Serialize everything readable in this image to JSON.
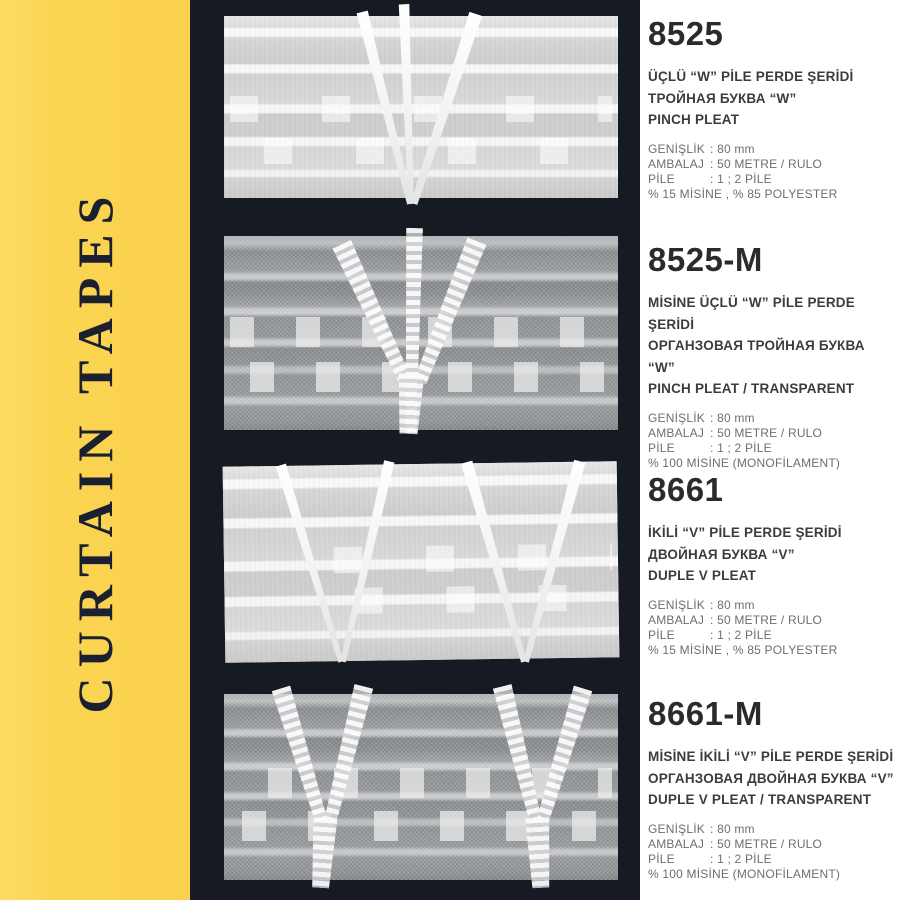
{
  "sidebar": {
    "title": "CURTAIN TAPES"
  },
  "colors": {
    "accent_yellow": "#fbd452",
    "panel_dark": "#161a23",
    "title_text": "#2b2b2b",
    "spec_text": "#6e6e6e",
    "sidebar_text": "#1b2030"
  },
  "products": [
    {
      "code": "8525",
      "image": "pinch-pleat-opaque-tape",
      "names": [
        "ÜÇLÜ “W” PİLE PERDE ŞERİDİ",
        "ТРОЙНАЯ БУКВА “W”",
        "PINCH PLEAT"
      ],
      "specs": [
        {
          "label": "GENİŞLİK",
          "value": ": 80 mm"
        },
        {
          "label": "AMBALAJ",
          "value": ": 50 METRE / RULO"
        },
        {
          "label": "PİLE",
          "value": ": 1 ; 2 PİLE"
        }
      ],
      "composition": "% 15 MİSİNE , % 85 POLYESTER"
    },
    {
      "code": "8525-M",
      "image": "pinch-pleat-transparent-tape",
      "names": [
        "MİSİNE ÜÇLÜ “W” PİLE PERDE ŞERİDİ",
        "ОРГАНЗОВАЯ ТРОЙНАЯ БУКВА “W”",
        "PINCH PLEAT / TRANSPARENT"
      ],
      "specs": [
        {
          "label": "GENİŞLİK",
          "value": ": 80 mm"
        },
        {
          "label": "AMBALAJ",
          "value": ": 50 METRE / RULO"
        },
        {
          "label": "PİLE",
          "value": ": 1 ; 2 PİLE"
        }
      ],
      "composition": "% 100 MİSİNE (MONOFİLAMENT)"
    },
    {
      "code": "8661",
      "image": "duple-v-pleat-opaque-tape",
      "names": [
        "İKİLİ “V” PİLE PERDE ŞERİDİ",
        "ДВОЙНАЯ БУКВА “V”",
        "DUPLE V PLEAT"
      ],
      "specs": [
        {
          "label": "GENİŞLİK",
          "value": ": 80 mm"
        },
        {
          "label": "AMBALAJ",
          "value": ": 50 METRE / RULO"
        },
        {
          "label": "PİLE",
          "value": ": 1 ; 2 PİLE"
        }
      ],
      "composition": "% 15 MİSİNE , % 85 POLYESTER"
    },
    {
      "code": "8661-M",
      "image": "duple-v-pleat-transparent-tape",
      "names": [
        "MİSİNE İKİLİ “V” PİLE PERDE ŞERİDİ",
        "ОРГАНЗОВАЯ ДВОЙНАЯ БУКВА “V”",
        "DUPLE V PLEAT / TRANSPARENT"
      ],
      "specs": [
        {
          "label": "GENİŞLİK",
          "value": ": 80 mm"
        },
        {
          "label": "AMBALAJ",
          "value": ": 50 METRE / RULO"
        },
        {
          "label": "PİLE",
          "value": ": 1 ; 2 PİLE"
        }
      ],
      "composition": "% 100 MİSİNE (MONOFİLAMENT)"
    }
  ]
}
